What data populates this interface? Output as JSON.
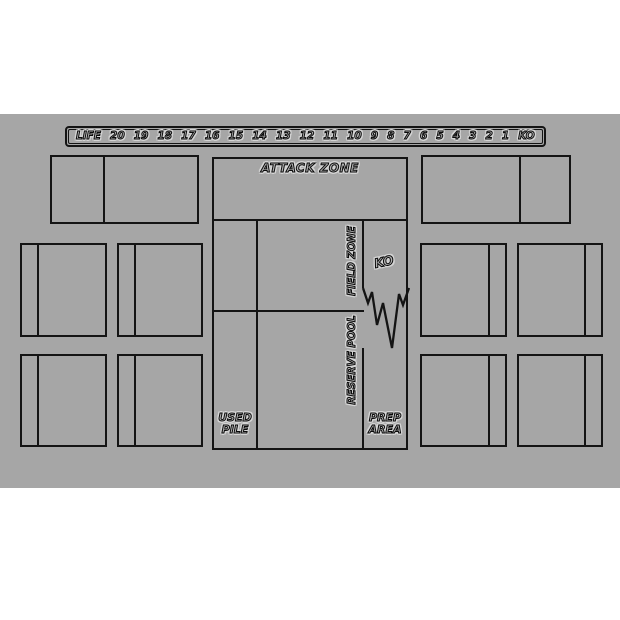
{
  "palette": {
    "mat_background": "#a6a6a6",
    "line_color": "#141414",
    "page_background": "#ffffff"
  },
  "life_track": {
    "label": "LIFE",
    "values": [
      "20",
      "19",
      "18",
      "17",
      "16",
      "15",
      "14",
      "13",
      "12",
      "11",
      "10",
      "9",
      "8",
      "7",
      "6",
      "5",
      "4",
      "3",
      "2",
      "1",
      "KO"
    ]
  },
  "zones": {
    "attack_zone": "ATTACK ZONE",
    "field_zone": "FIELD ZONE",
    "reserve_pool": "RESERVE POOL",
    "ko": "KO",
    "used_pile": {
      "line1": "USED",
      "line2": "PILE"
    },
    "prep_area": {
      "line1": "PREP",
      "line2": "AREA"
    }
  }
}
